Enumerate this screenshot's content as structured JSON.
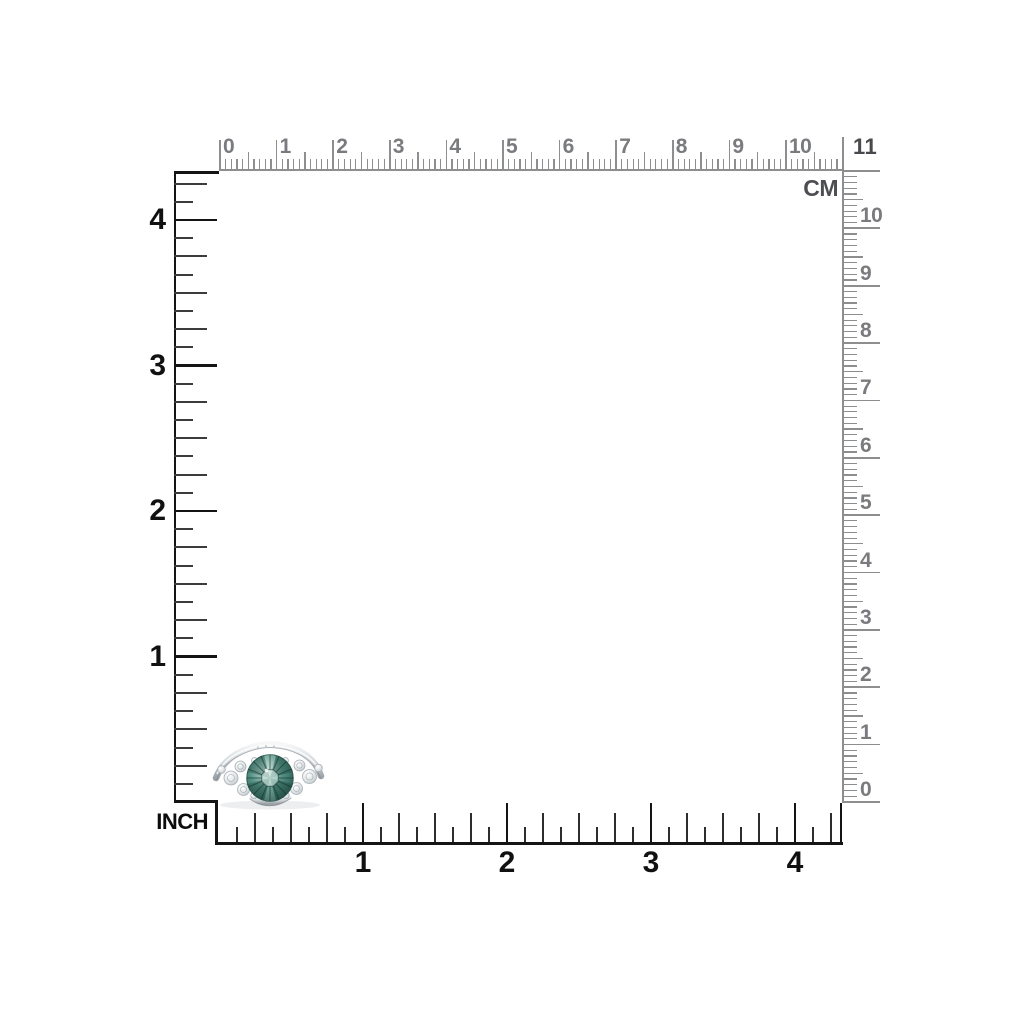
{
  "image_type": "jewelry-product-scale-photo",
  "background_color": "#ffffff",
  "rulers": {
    "cm_top": {
      "unit_label": "CM",
      "end_label": "11",
      "numbers": [
        "0",
        "1",
        "2",
        "3",
        "4",
        "5",
        "6",
        "7",
        "8",
        "9",
        "10"
      ],
      "tick_color": "#8d8e90",
      "number_color": "#7a7b7e",
      "label_color": "#4d4e51"
    },
    "cm_right": {
      "numbers": [
        "10",
        "9",
        "8",
        "7",
        "6",
        "5",
        "4",
        "3",
        "2",
        "1",
        "0"
      ],
      "tick_color": "#8d8e90",
      "number_color": "#7a7b7e"
    },
    "inch_left": {
      "unit_label": "INCH",
      "numbers": [
        "4",
        "3",
        "2",
        "1"
      ],
      "tick_color": "#141414",
      "subtick_color": "#3b3b3c",
      "number_color": "#111111",
      "label_color": "#0c0c0c"
    },
    "inch_bottom": {
      "numbers": [
        "1",
        "2",
        "3",
        "4"
      ],
      "tick_color": "#141414",
      "subtick_color": "#2d2d2e",
      "number_color": "#111111"
    }
  },
  "ring": {
    "description": "silver ring with round green gemstone and white diamond side clusters",
    "band_light": "#f5f7f8",
    "band_mid": "#d5dadd",
    "band_dark": "#99a0a6",
    "gem_light": "#c8e6db",
    "gem_mid": "#549084",
    "gem_dark": "#24504695",
    "gem_edge": "#1d453c",
    "stone_light": "#ffffff",
    "stone_mid": "#e3e7e9",
    "stone_dark": "#b7bfc4"
  }
}
